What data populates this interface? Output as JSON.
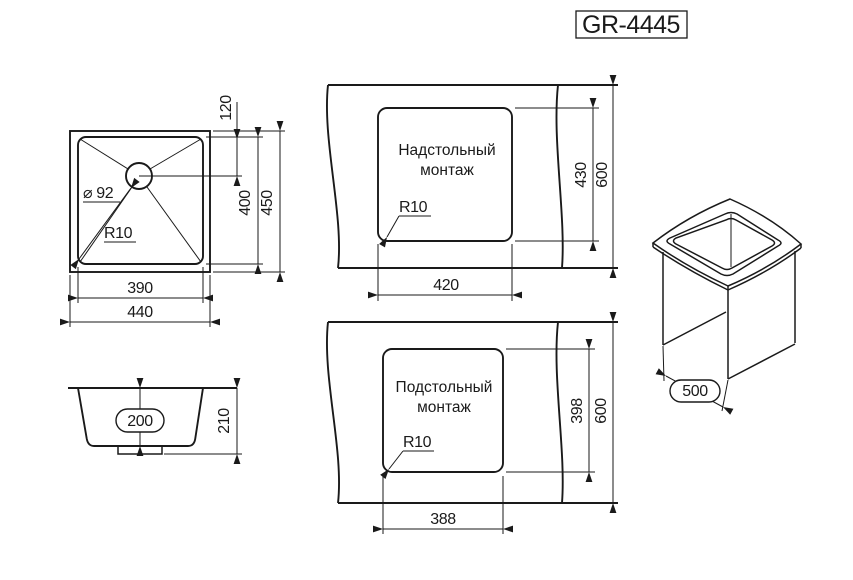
{
  "title": "GR-4445",
  "colors": {
    "line": "#1a1a1a",
    "background": "#ffffff"
  },
  "top_view": {
    "drain_diameter": "⌀ 92",
    "corner_radius": "R10",
    "dim_drain_offset": "120",
    "dim_inner_height": "400",
    "dim_outer_height": "450",
    "dim_inner_width": "390",
    "dim_outer_width": "440"
  },
  "side_view": {
    "dim_inner_depth": "200",
    "dim_outer_depth": "210"
  },
  "overmount_view": {
    "label_line1": "Надстольный",
    "label_line2": "монтаж",
    "corner_radius": "R10",
    "dim_cutout_height": "430",
    "dim_counter_height": "600",
    "dim_cutout_width": "420"
  },
  "undermount_view": {
    "label_line1": "Подстольный",
    "label_line2": "монтаж",
    "corner_radius": "R10",
    "dim_cutout_height": "398",
    "dim_counter_height": "600",
    "dim_cutout_width": "388"
  },
  "iso_view": {
    "dim_cabinet_width": "500"
  }
}
